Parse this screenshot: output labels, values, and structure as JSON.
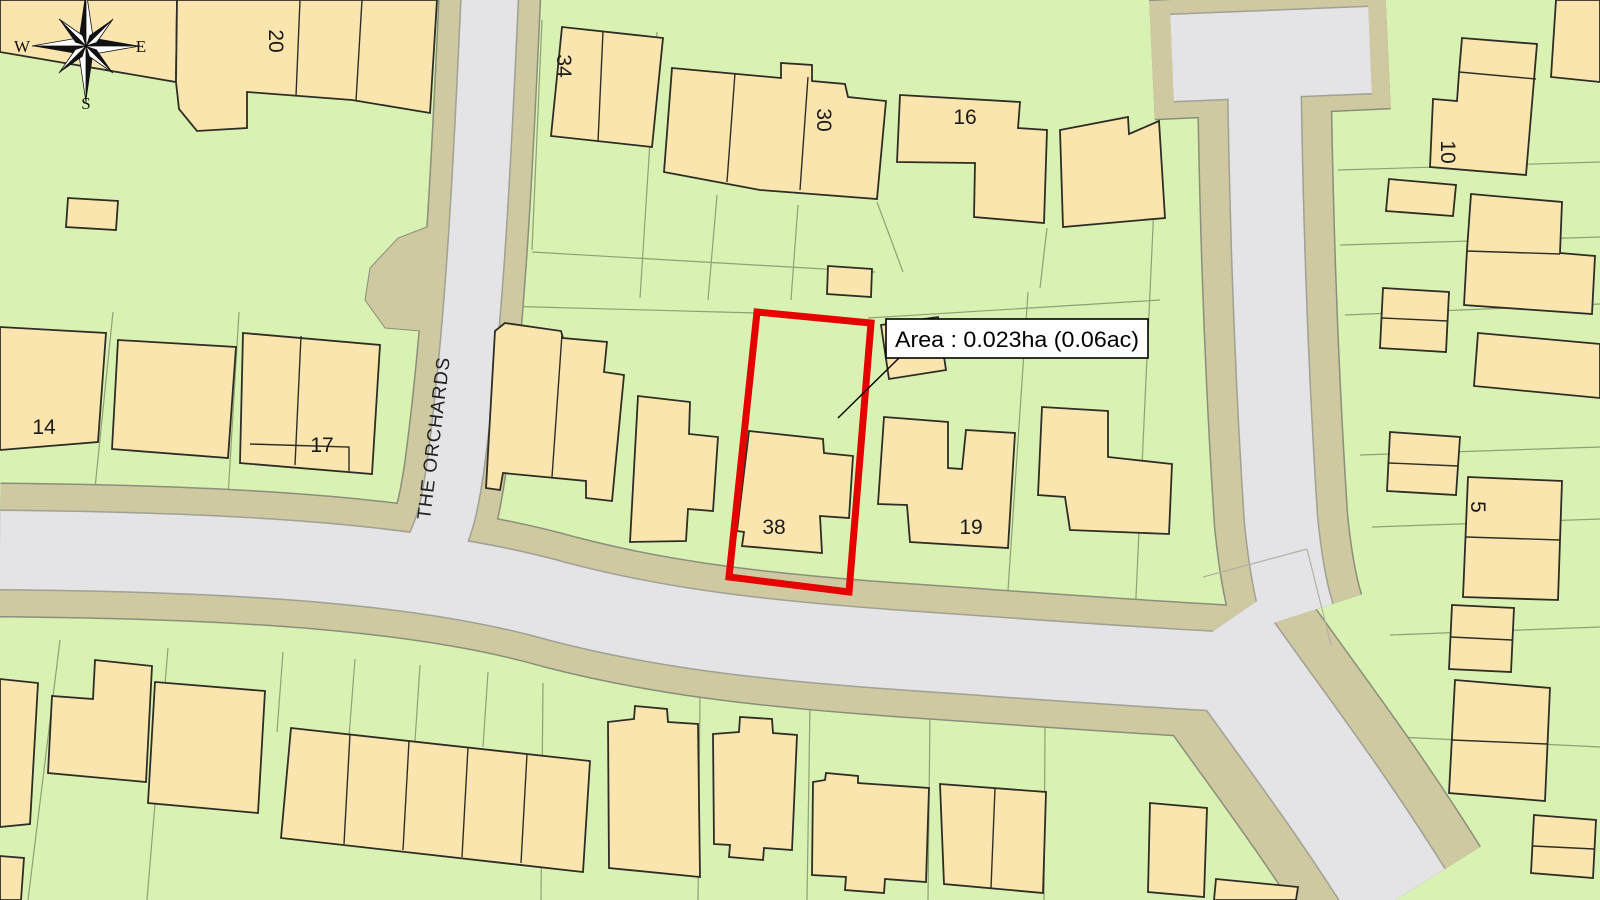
{
  "map": {
    "annotation": {
      "area_label": "Area : 0.023ha (0.06ac)"
    },
    "street": {
      "name": "THE ORCHARDS"
    },
    "compass": {
      "west": "W",
      "east": "E",
      "south": "S"
    },
    "house_numbers": {
      "n20": "20",
      "n34": "34",
      "n30": "30",
      "n16": "16",
      "n10": "10",
      "n14": "14",
      "n17": "17",
      "n38": "38",
      "n19": "19",
      "n5": "5"
    },
    "colors": {
      "parcel_green": "#d9f1b2",
      "building_fill": "#fbe5af",
      "building_line": "#2e2e24",
      "road_surface": "#e4e3e6",
      "road_verge": "#cfc9a1",
      "plot_outline_red": "#e60000",
      "label_background": "#ffffff"
    }
  }
}
